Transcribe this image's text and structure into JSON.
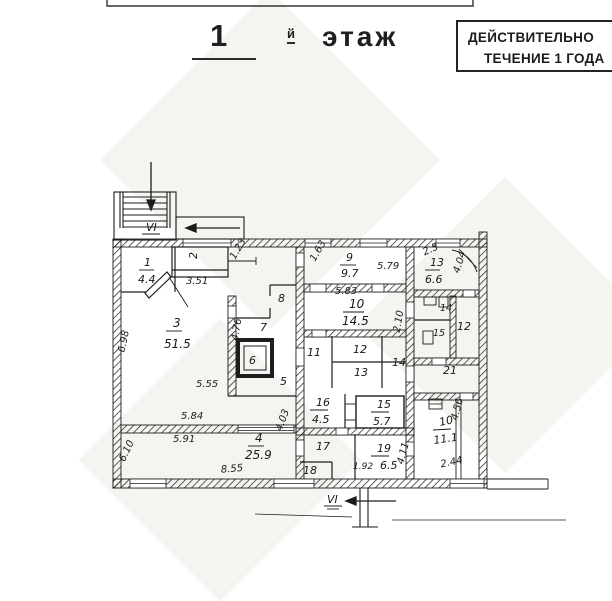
{
  "header": {
    "floor_number": "1",
    "floor_suffix": "й",
    "floor_word": "этаж"
  },
  "stamp": {
    "line1": "ДЕЙСТВИТЕЛЬНО",
    "line2": "ТЕЧЕНИЕ 1 ГОДА"
  },
  "plan": {
    "stair_top_label": "VI",
    "stair_bottom_label": "VI",
    "rooms": [
      {
        "number": "1",
        "area": "4.4"
      },
      {
        "number": "2"
      },
      {
        "number": "3",
        "area": "51.5"
      },
      {
        "number": "4",
        "area": "25.9"
      },
      {
        "number": "5"
      },
      {
        "number": "6"
      },
      {
        "number": "7"
      },
      {
        "number": "8"
      },
      {
        "number": "9",
        "area": "9.7"
      },
      {
        "number": "10",
        "area": "14.5"
      },
      {
        "number": "11"
      },
      {
        "number": "12"
      },
      {
        "number": "13"
      },
      {
        "number": "14"
      },
      {
        "number": "16",
        "area": "4.5"
      },
      {
        "number": "15",
        "area": "5.7"
      },
      {
        "number": "17"
      },
      {
        "number": "18"
      },
      {
        "number": "19",
        "area": "6.5"
      },
      {
        "number": "13",
        "area": "6.6"
      },
      {
        "number": "14"
      },
      {
        "number": "15"
      },
      {
        "number": "12"
      },
      {
        "number": "21"
      },
      {
        "number": "10",
        "area": "11.1"
      }
    ],
    "dimensions": [
      "3.51",
      "1.23",
      "1.63",
      "5.79",
      "5.83",
      "2.5",
      "4.04",
      "6.98",
      "4.76",
      "2.10",
      "5.55",
      "5.84",
      "5.91",
      "4.03",
      "6.10",
      "8.55",
      "1.92",
      "4.11",
      "4.56",
      "2.44"
    ]
  }
}
